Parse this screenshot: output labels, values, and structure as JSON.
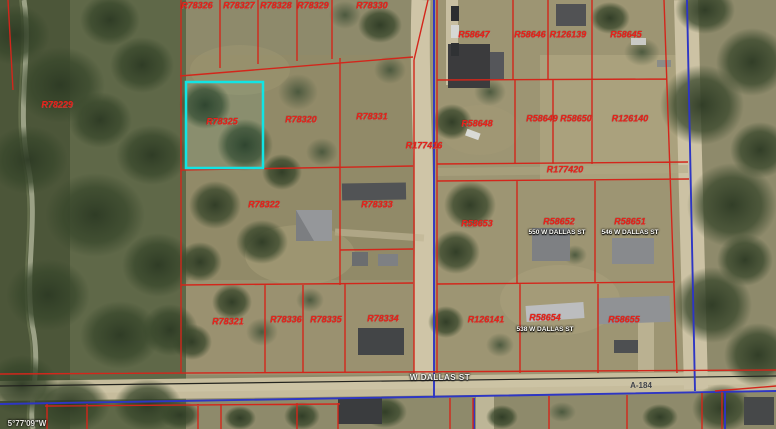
{
  "map": {
    "selected_parcel": "R78325",
    "colors": {
      "parcel_line": "#d3261b",
      "road_line": "#2e36c4",
      "highlight": "#12e4e4",
      "label": "#e8231a"
    },
    "parcels": [
      {
        "id": "R78326",
        "x": 197,
        "y": 6
      },
      {
        "id": "R78327",
        "x": 239,
        "y": 6
      },
      {
        "id": "R78328",
        "x": 276,
        "y": 6
      },
      {
        "id": "R78329",
        "x": 313,
        "y": 6
      },
      {
        "id": "R78330",
        "x": 372,
        "y": 6
      },
      {
        "id": "R58647",
        "x": 474,
        "y": 35
      },
      {
        "id": "R58646",
        "x": 530,
        "y": 35
      },
      {
        "id": "R126139",
        "x": 568,
        "y": 35
      },
      {
        "id": "R58645",
        "x": 626,
        "y": 35
      },
      {
        "id": "R78229",
        "x": 57,
        "y": 105
      },
      {
        "id": "R78325",
        "x": 222,
        "y": 122
      },
      {
        "id": "R78320",
        "x": 301,
        "y": 120
      },
      {
        "id": "R78331",
        "x": 372,
        "y": 117
      },
      {
        "id": "R177416",
        "x": 424,
        "y": 146
      },
      {
        "id": "R58648",
        "x": 477,
        "y": 124
      },
      {
        "id": "R58649",
        "x": 542,
        "y": 119
      },
      {
        "id": "R58650",
        "x": 576,
        "y": 119
      },
      {
        "id": "R126140",
        "x": 630,
        "y": 119
      },
      {
        "id": "R177420",
        "x": 565,
        "y": 170
      },
      {
        "id": "R78322",
        "x": 264,
        "y": 205
      },
      {
        "id": "R78333",
        "x": 377,
        "y": 205
      },
      {
        "id": "R58653",
        "x": 477,
        "y": 224
      },
      {
        "id": "R58652",
        "x": 559,
        "y": 222
      },
      {
        "id": "R58651",
        "x": 630,
        "y": 222
      },
      {
        "id": "R78321",
        "x": 228,
        "y": 322
      },
      {
        "id": "R78336",
        "x": 286,
        "y": 320
      },
      {
        "id": "R78335",
        "x": 326,
        "y": 320
      },
      {
        "id": "R78334",
        "x": 383,
        "y": 319
      },
      {
        "id": "R126141",
        "x": 486,
        "y": 320
      },
      {
        "id": "R58654",
        "x": 545,
        "y": 318
      },
      {
        "id": "R58655",
        "x": 624,
        "y": 320
      }
    ],
    "addresses": [
      {
        "text": "550 W DALLAS ST",
        "x": 557,
        "y": 233
      },
      {
        "text": "546 W DALLAS ST",
        "x": 630,
        "y": 233
      },
      {
        "text": "538 W DALLAS ST",
        "x": 545,
        "y": 330
      }
    ],
    "road_labels": [
      {
        "text": "W DALLAS ST",
        "x": 440,
        "y": 378,
        "style": "halo"
      },
      {
        "text": "A-184",
        "x": 641,
        "y": 386,
        "style": "dark"
      }
    ],
    "coordinate_label": {
      "text": "5°77'09\"W",
      "x": 27,
      "y": 424
    }
  }
}
